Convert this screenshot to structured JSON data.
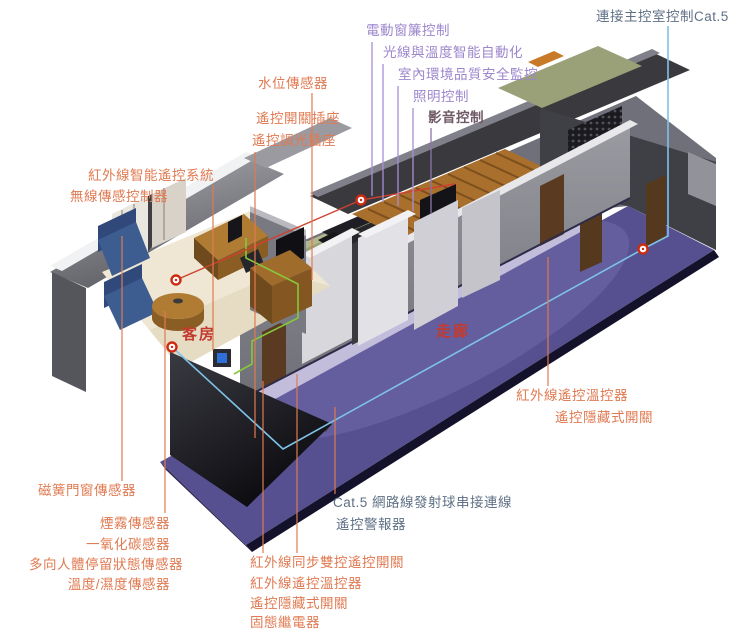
{
  "colors": {
    "label_salmon": "#E07A52",
    "label_purple": "#9C86CC",
    "label_purple_dark": "#6F5A66",
    "label_slate_blue": "#5F7086",
    "room_label_red": "#C23B2E",
    "cat5_cable_blue": "#7EC2E8",
    "wire_green": "#86C83C",
    "ir_link_red": "#D0402F",
    "corridor_floor_purple": "#565090"
  },
  "rooms": {
    "guest_room": "客房",
    "corridor": "走廊"
  },
  "labels_top_purple": {
    "curtain_control": "電動窗簾控制",
    "light_temp_automation": "光線與溫度智能自動化",
    "indoor_env_monitoring": "室內環境品質安全監控",
    "lighting_control": "照明控制",
    "av_control": "影音控制"
  },
  "label_cat5_main": "連接主控室控制Cat.5",
  "labels_left": {
    "water_level_sensor": "水位傳感器",
    "remote_switch_socket": "遙控開關插座",
    "remote_dimmer_socket": "遙控調光插座",
    "ir_smart_remote_system": "紅外線智能遙控系統",
    "wireless_sensor_controller": "無線傳感控制器",
    "magnetic_door_window_sensor": "磁簧門窗傳感器",
    "smoke_sensor": "煙霧傳感器",
    "co_sensor": "一氧化碳感器",
    "presence_sensor": "多向人體停留狀態傳感器",
    "temp_humidity_sensor": "溫度/濕度傳感器"
  },
  "labels_bottom": {
    "ir_sync_dual_switch": "紅外線同步雙控遙控開關",
    "ir_remote_thermostat": "紅外線遙控溫控器",
    "remote_hidden_switch": "遙控隱藏式開關",
    "solid_state_relay": "固態繼電器",
    "cat5_chain": "Cat.5 網路線發射球串接連線",
    "remote_alarm": "遙控警報器"
  },
  "labels_right": {
    "ir_remote_thermostat": "紅外線遙控溫控器",
    "remote_hidden_switch": "遙控隱藏式開關"
  }
}
